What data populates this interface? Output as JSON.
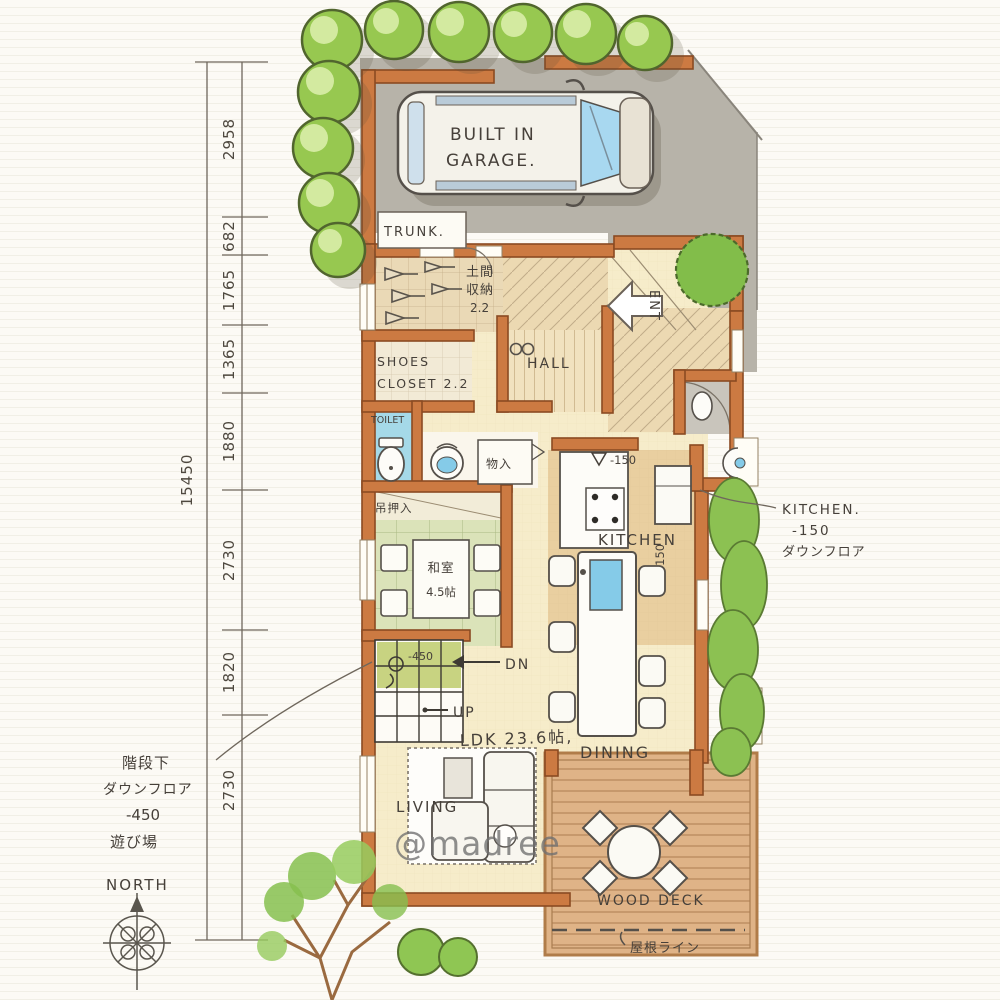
{
  "watermark": "@madree",
  "compass": {
    "north": "NORTH"
  },
  "dimensions": {
    "total": "15450",
    "segments": [
      "2958",
      "682",
      "1765",
      "1365",
      "1880",
      "2730",
      "1820",
      "2730"
    ]
  },
  "garage": {
    "line1": "BUILT IN",
    "line2": "GARAGE."
  },
  "rooms": {
    "trunk": "TRUNK.",
    "doma_line1": "土間",
    "doma_line2": "収納",
    "doma_size": "2.2",
    "shoes_line1": "SHOES",
    "shoes_line2": "CLOSET 2.2",
    "hall": "HALL",
    "entrance": "ENT",
    "toilet": "TOILET",
    "storage": "物入",
    "hanging_closet": "吊押入",
    "tatami_name": "和室",
    "tatami_size": "4.5帖",
    "kitchen": "KITCHEN",
    "living": "LIVING",
    "ldk": "LDK 23.6帖,",
    "dining": "DINING",
    "wood_deck": "WOOD DECK"
  },
  "stairs": {
    "down": "DN",
    "up": "UP",
    "pit_depth": "-450"
  },
  "steps": {
    "kitchen_top": "-150",
    "kitchen_side": "-150"
  },
  "notes": {
    "kitchen": [
      "KITCHEN.",
      "-150",
      "ダウンフロア"
    ],
    "under_stairs": [
      "階段下",
      "ダウンフロア",
      "-450",
      "遊び場"
    ],
    "roof_line": "屋根ライン"
  },
  "colors": {
    "wall": "#cc7a42",
    "wall_edge": "#8a4a22",
    "driveway": "#b7b3a9",
    "tatami": "#dbe3b9",
    "toilet_floor": "#a5d9e8",
    "sink_blue": "#85cbe8",
    "wood_deck": "#dfb387",
    "tree": "#97c850",
    "floor": "#f6ecca",
    "stairs_pit": "#c3cf76",
    "ink": "#46403a"
  }
}
